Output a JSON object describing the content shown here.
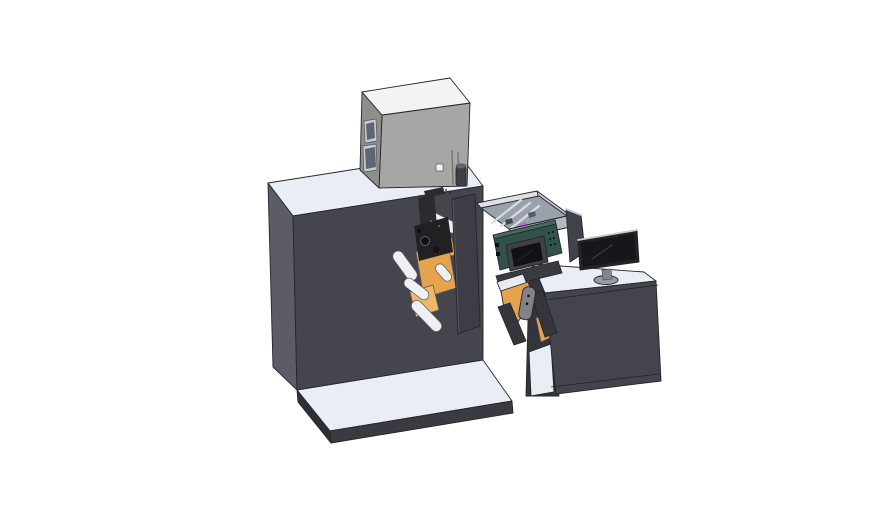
{
  "meta": {
    "title": "3D CAD render of a label press machine with top equipment box, web-guide rollers, HMI screen panel, outfeed and operator desk with monitor",
    "background": "#ffffff"
  },
  "colors": {
    "background": "#ffffff",
    "machineFront": "#45454d",
    "machineSide": "#5c5c66",
    "surfaceLight": "#e9edf5",
    "baseFront": "#3a3a41",
    "baseSide": "#2e2e35",
    "boxTop": "#f3f3f1",
    "boxFront": "#a6a6a4",
    "boxSide": "#8e8e8c",
    "windowFrame": "#c9cdd2",
    "windowGlass": "#5d6672",
    "ventLine": "#73736f",
    "cylinderBody": "#3f3f45",
    "cylinderTop": "#65656d",
    "trayRim": "#dde1e7",
    "trayWallRight": "#c6cbd2",
    "trayWallFront": "#b3b9c1",
    "trayFloor": "#99a1ab",
    "trayRail": "#d9dde3",
    "magentaPart": "#c95fd0",
    "trayPartDark": "#434a52",
    "trayPartGray": "#565e66",
    "divider": "#42424a",
    "deskInterior": "#34343b",
    "deskFront": "#44444c",
    "orange": "#e5a34e",
    "orangeLight": "#efb766",
    "monitorFrame": "#222227",
    "monitorScreen": "#17171b",
    "monitorEdge": "#c9ccd4",
    "standBase": "#9a9aa3",
    "standNeck": "#85858e",
    "rewindBar": "#3a3a41",
    "rampWhite": "#e8ebf2",
    "legDark": "#35353c",
    "handleGray": "#82828b",
    "roller": "#eef0f4",
    "blackPart": "#212124",
    "blackPart2": "#2b2b2f",
    "topBits": "#2c2c30",
    "diePlate": "#3d3d45",
    "tealTop": "#46685e",
    "tealFace": "#31524a",
    "bezel": "#3e4146",
    "screenDark": "#121216",
    "dotDark": "#0f0f12",
    "markDot": "#222226"
  },
  "scene": {
    "objects": [
      {
        "name": "main-press-cabinet"
      },
      {
        "name": "top-equipment-box"
      },
      {
        "name": "web-roller-mechanism"
      },
      {
        "name": "parts-tray"
      },
      {
        "name": "hmi-control-panel"
      },
      {
        "name": "outfeed-frame"
      },
      {
        "name": "operator-desk"
      },
      {
        "name": "desktop-monitor"
      },
      {
        "name": "machine-base-plate"
      }
    ]
  }
}
